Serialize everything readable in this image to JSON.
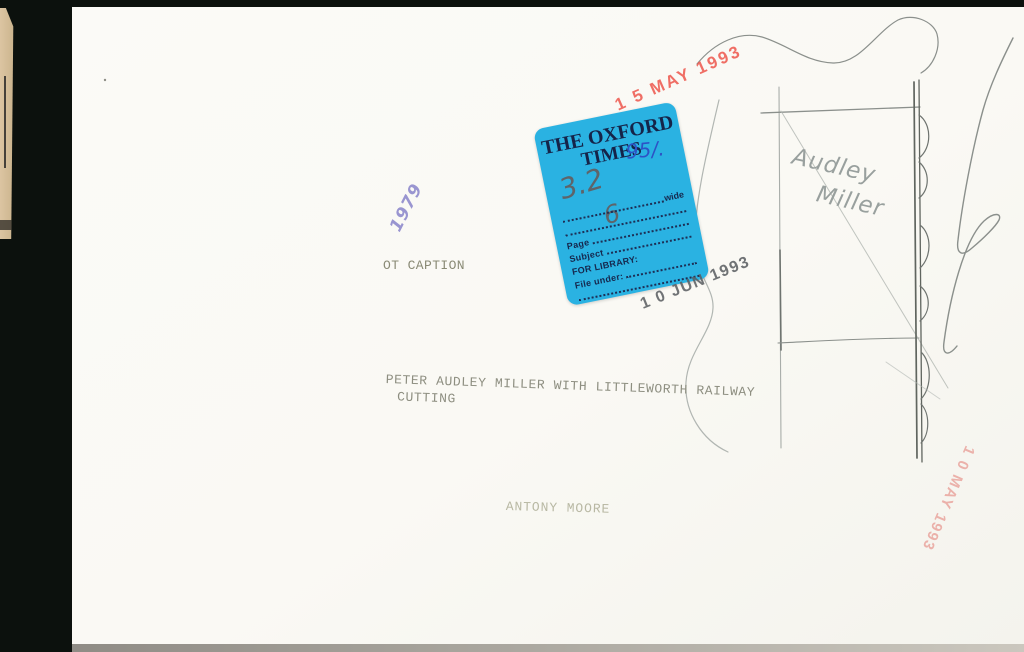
{
  "paper": {
    "stamps": {
      "received_red_top": "1 5 MAY 1993",
      "received_black_jun": "1 0 JUN 1993",
      "received_red_side": "1 0 MAY 1993",
      "year_purple": "1979"
    },
    "typed": {
      "ot_caption": "OT CAPTION",
      "caption_line1": "PETER AUDLEY MILLER WITH LITTLEWORTH RAILWAY",
      "caption_line2": "CUTTING",
      "credit": "ANTONY MOORE"
    },
    "handwriting": {
      "pencil_name_line1": "Audley",
      "pencil_name_line2": "Miller"
    },
    "sticker": {
      "title_line1": "THE OXFORD",
      "title_line2": "TIMES",
      "pen_note": "95/.",
      "pencil_size": "3.2",
      "pencil_page": "6",
      "rows": [
        {
          "label": "",
          "suffix": "wide"
        },
        {
          "label": "",
          "suffix": ""
        },
        {
          "label": "Page",
          "suffix": ""
        },
        {
          "label": "Subject",
          "suffix": ""
        },
        {
          "label": "FOR LIBRARY:",
          "suffix": ""
        },
        {
          "label": "File under:",
          "suffix": ""
        },
        {
          "label": "",
          "suffix": ""
        }
      ]
    },
    "colors": {
      "sticker_blue": "#2ab2e2",
      "sticker_navy": "#16284e",
      "stamp_red": "#ee564c",
      "stamp_red_faded": "#e9a19a",
      "stamp_black": "#585c60",
      "stamp_purple": "#8f8bcd",
      "pencil_gray": "#99a09e",
      "paper_white": "#fafaf5",
      "mount_black": "#0c110d",
      "film_tan": "#dcc5a2"
    }
  }
}
